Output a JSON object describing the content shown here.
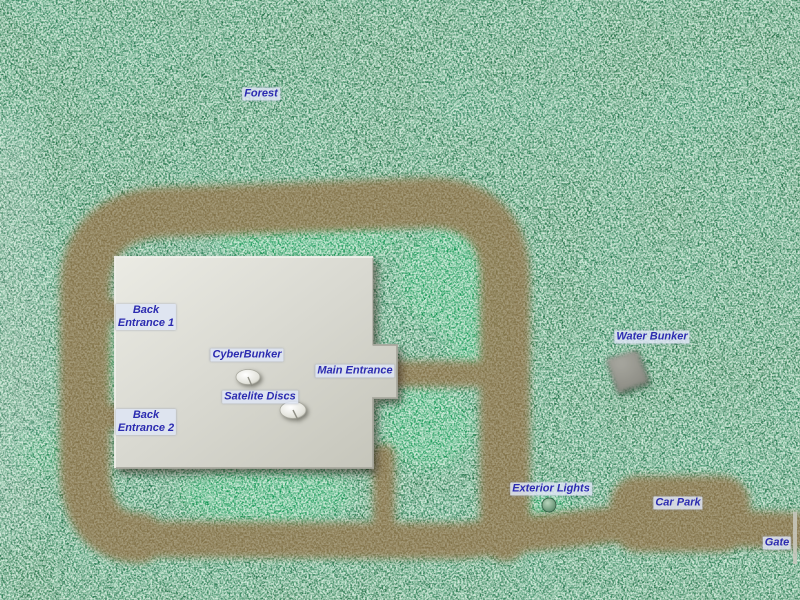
{
  "map": {
    "labels": [
      {
        "id": "forest",
        "text": "Forest",
        "x": 261,
        "y": 94
      },
      {
        "id": "back-entrance-1",
        "text": "Back\nEntrance 1",
        "x": 146,
        "y": 317
      },
      {
        "id": "cyberbunker",
        "text": "CyberBunker",
        "x": 247,
        "y": 355
      },
      {
        "id": "satelite-discs",
        "text": "Satelite Discs",
        "x": 260,
        "y": 397
      },
      {
        "id": "main-entrance",
        "text": "Main Entrance",
        "x": 355,
        "y": 371
      },
      {
        "id": "back-entrance-2",
        "text": "Back\nEntrance 2",
        "x": 146,
        "y": 422
      },
      {
        "id": "water-bunker",
        "text": "Water Bunker",
        "x": 652,
        "y": 337
      },
      {
        "id": "exterior-lights",
        "text": "Exterior Lights",
        "x": 551,
        "y": 489
      },
      {
        "id": "car-park",
        "text": "Car Park",
        "x": 678,
        "y": 503
      },
      {
        "id": "gate",
        "text": "Gate",
        "x": 777,
        "y": 543
      }
    ],
    "features": [
      {
        "name": "bunker-building",
        "x": 256,
        "y": 362
      },
      {
        "name": "satellite-dish-1",
        "x": 248,
        "y": 377
      },
      {
        "name": "satellite-dish-2",
        "x": 293,
        "y": 410
      },
      {
        "name": "water-bunker-rock",
        "x": 627,
        "y": 371
      },
      {
        "name": "exterior-light",
        "x": 549,
        "y": 505
      },
      {
        "name": "gate-barrier",
        "x": 796,
        "y": 540
      }
    ],
    "colors": {
      "forest_base": "#236f45",
      "forest_dark": "#0a4a2a",
      "forest_speckle": "#cde9d6",
      "grass_bright": "#0f9b52",
      "road": "#8a7348",
      "building_light": "#e8e8e1",
      "building_dark": "#c6c6bb",
      "label_bg": "#dee5f4",
      "label_text": "#2b2bb0"
    }
  }
}
